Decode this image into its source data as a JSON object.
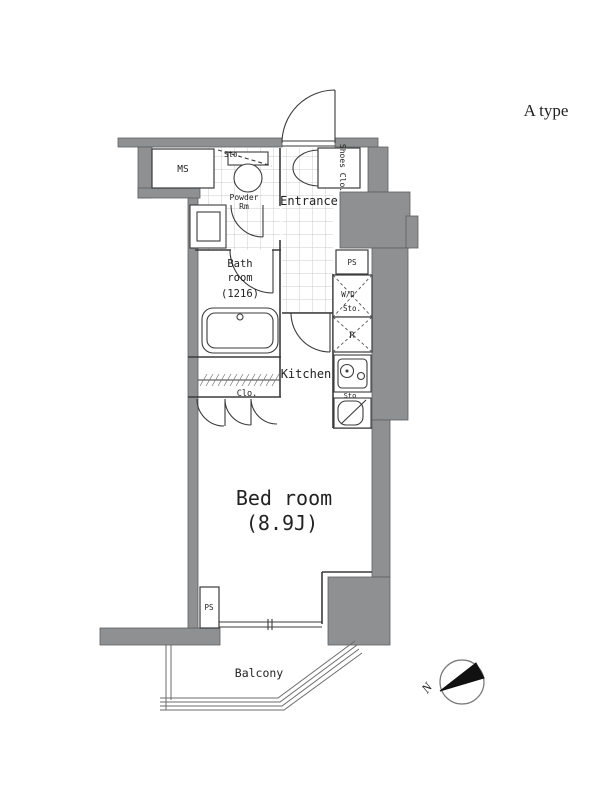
{
  "page": {
    "type_label": "A type"
  },
  "plan": {
    "rooms": {
      "ms": "MS",
      "storage_top": "Sto.",
      "powder_1": "Powder",
      "powder_2": "Rm",
      "entrance": "Entrance",
      "shoes_closet": "Shoes Clo.",
      "bath_1": "Bath",
      "bath_2": "room",
      "bath_3": "(1216)",
      "closet": "Clo.",
      "kitchen": "Kitchen",
      "wd_1": "W/D",
      "wd_2": "Sto.",
      "fridge": "R",
      "ps_upper": "PS",
      "sink_storage": "Sto",
      "bedroom_name": "Bed room",
      "bedroom_size": "(8.9J)",
      "ps_lower": "PS",
      "balcony": "Balcony"
    },
    "compass": {
      "north": "N"
    },
    "colors": {
      "wall": "#8e9091",
      "line": "#3b3b3b",
      "tile_line": "#cccccc",
      "background": "#ffffff"
    }
  }
}
